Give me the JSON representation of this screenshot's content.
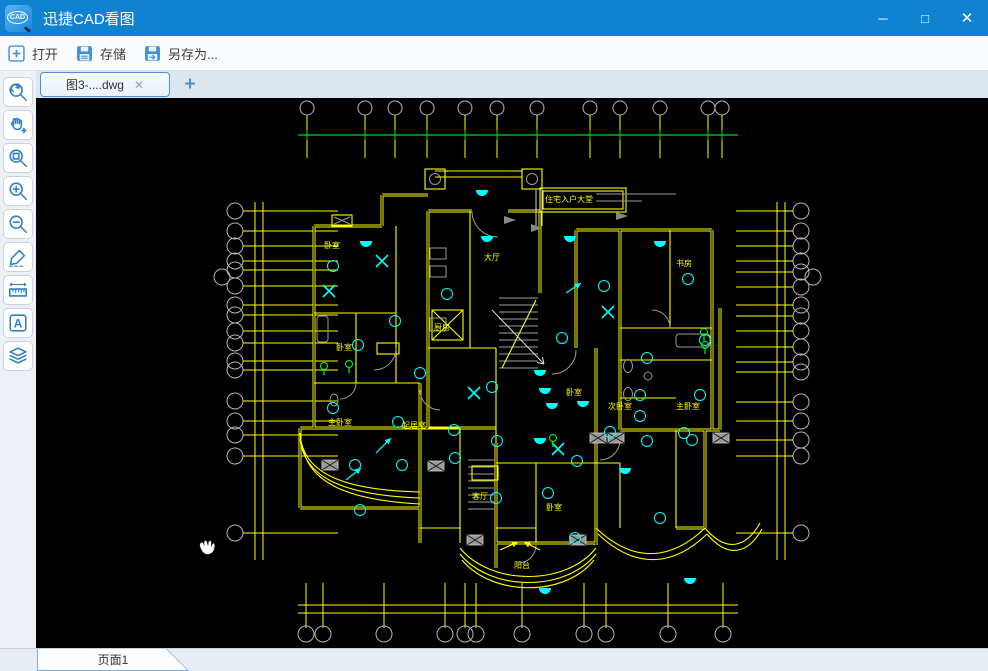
{
  "window": {
    "title": "迅捷CAD看图",
    "app_icon": "cad-logo-icon",
    "controls": {
      "minimize": "─",
      "maximize": "□",
      "close": "✕"
    }
  },
  "toolbar": {
    "items": [
      {
        "icon": "plus-box-icon",
        "label": "打开"
      },
      {
        "icon": "save-icon",
        "label": "存储"
      },
      {
        "icon": "save-as-icon",
        "label": "另存为..."
      }
    ]
  },
  "tabbar": {
    "active_tab": {
      "label": "图3-....dwg",
      "close_glyph": "✕"
    },
    "add_tab_glyph": "+"
  },
  "sidebar": {
    "tools": [
      "zoom-extents",
      "pan",
      "zoom-window",
      "zoom-in",
      "zoom-out",
      "draw",
      "measure",
      "text",
      "layers"
    ]
  },
  "statusbar": {
    "page_tab": "页面1"
  },
  "colors": {
    "titlebar": "#1181d2",
    "accent_blue": "#2f80c8",
    "wall_yellow": "#ffff00",
    "symbol_cyan": "#00ffff",
    "axis_green": "#00dd00",
    "axis_gray": "#b4b4b4",
    "canvas": "#000000"
  },
  "drawing": {
    "axes": {
      "top_x": [
        271,
        329,
        359,
        391,
        429,
        461,
        501,
        554,
        584,
        624,
        672,
        686
      ],
      "top_circle_y": 10,
      "top_tick_y1": 17,
      "top_tick_y2": 60,
      "green_line": {
        "y": 37,
        "x1": 262,
        "x2": 702
      },
      "left_x": 199,
      "left_tick_x2": 302,
      "left_y": [
        113,
        133,
        148,
        163,
        172,
        188,
        207,
        217,
        233,
        245,
        263,
        272,
        303,
        323,
        337,
        358,
        435
      ],
      "left_vlines_x": [
        219,
        227
      ],
      "side_vline_y1": 104,
      "side_vline_y2": 462,
      "right_x": 765,
      "right_tick_x2": 700,
      "right_y": [
        113,
        133,
        148,
        163,
        174,
        189,
        207,
        218,
        233,
        249,
        264,
        274,
        304,
        323,
        342,
        358,
        435
      ],
      "right_vlines_x": [
        741,
        749
      ],
      "extra_circles": [
        [
          186,
          179
        ],
        [
          777,
          179
        ]
      ],
      "bottom_lines_y": [
        507,
        515
      ],
      "bottom_line_x1": 262,
      "bottom_line_x2": 702,
      "bottom_tick_y1": 485,
      "bottom_tick_y2": 530,
      "bottom_x": [
        270,
        287,
        348,
        409,
        429,
        440,
        486,
        548,
        570,
        632,
        687
      ],
      "bottom_circle_y": 536,
      "circle_r_top": 7,
      "circle_r_side": 8
    },
    "lights": [
      [
        297,
        168
      ],
      [
        322,
        247
      ],
      [
        362,
        324
      ],
      [
        384,
        275
      ],
      [
        419,
        360
      ],
      [
        456,
        289
      ],
      [
        526,
        240
      ],
      [
        568,
        188
      ],
      [
        611,
        260
      ],
      [
        574,
        334
      ],
      [
        604,
        318
      ],
      [
        648,
        335
      ],
      [
        652,
        181
      ],
      [
        669,
        242
      ],
      [
        541,
        363
      ],
      [
        324,
        412
      ],
      [
        460,
        400
      ],
      [
        512,
        395
      ],
      [
        624,
        420
      ],
      [
        539,
        440
      ],
      [
        411,
        196
      ],
      [
        297,
        310
      ],
      [
        359,
        223
      ],
      [
        366,
        367
      ],
      [
        319,
        367
      ],
      [
        418,
        332
      ],
      [
        461,
        343
      ],
      [
        604,
        297
      ],
      [
        664,
        297
      ],
      [
        611,
        343
      ],
      [
        656,
        342
      ]
    ],
    "half_lamps": [
      [
        451,
        138
      ],
      [
        446,
        92
      ],
      [
        534,
        138
      ],
      [
        624,
        143
      ],
      [
        504,
        272
      ],
      [
        509,
        290
      ],
      [
        516,
        305
      ],
      [
        547,
        303
      ],
      [
        504,
        340
      ],
      [
        509,
        490
      ],
      [
        654,
        480
      ],
      [
        330,
        143
      ],
      [
        589,
        370
      ]
    ],
    "x_marks": [
      [
        346,
        163
      ],
      [
        293,
        193
      ],
      [
        572,
        214
      ],
      [
        438,
        295
      ],
      [
        522,
        351
      ]
    ],
    "green_marks": [
      [
        288,
        268
      ],
      [
        313,
        266
      ],
      [
        668,
        234
      ],
      [
        669,
        247
      ],
      [
        517,
        340
      ]
    ],
    "arrows": [
      [
        340,
        355,
        355,
        340
      ],
      [
        310,
        382,
        325,
        370
      ],
      [
        530,
        195,
        545,
        185
      ],
      [
        464,
        452,
        482,
        444
      ],
      [
        504,
        452,
        488,
        444
      ]
    ],
    "columns": [
      [
        286,
        362
      ],
      [
        392,
        363
      ],
      [
        431,
        437
      ],
      [
        534,
        437
      ],
      [
        554,
        335
      ],
      [
        572,
        335
      ],
      [
        677,
        335
      ]
    ],
    "stairs": [
      {
        "x1": 463,
        "x2": 502,
        "y1": 200,
        "y2": 272,
        "step": 7
      },
      {
        "x1": 432,
        "x2": 458,
        "y1": 362,
        "y2": 414,
        "step": 7
      }
    ],
    "labels": [
      {
        "t": "卧室",
        "x": 288,
        "y": 150
      },
      {
        "t": "厨房",
        "x": 398,
        "y": 232
      },
      {
        "t": "大厅",
        "x": 448,
        "y": 162
      },
      {
        "t": "书房",
        "x": 640,
        "y": 168
      },
      {
        "t": "卧室",
        "x": 300,
        "y": 252
      },
      {
        "t": "住宅入户大堂",
        "x": 509,
        "y": 104
      },
      {
        "t": "卧室",
        "x": 530,
        "y": 297
      },
      {
        "t": "次卧室",
        "x": 572,
        "y": 311
      },
      {
        "t": "主卧室",
        "x": 640,
        "y": 311
      },
      {
        "t": "主卧室",
        "x": 292,
        "y": 327
      },
      {
        "t": "起居室",
        "x": 366,
        "y": 330
      },
      {
        "t": "客厅",
        "x": 436,
        "y": 401
      },
      {
        "t": "卧室",
        "x": 510,
        "y": 412
      },
      {
        "t": "阳台",
        "x": 478,
        "y": 470
      }
    ]
  }
}
